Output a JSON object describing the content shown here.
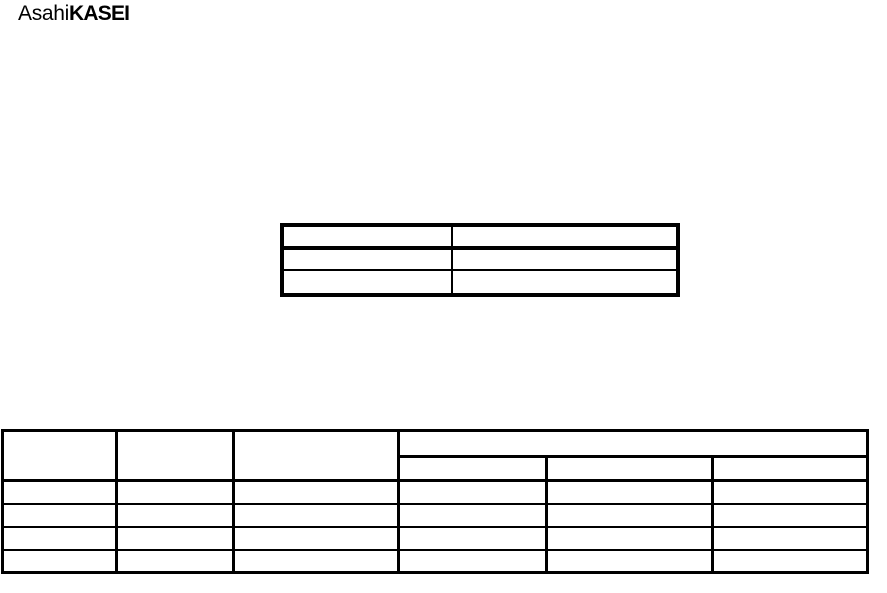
{
  "page": {
    "background": "#ffffff",
    "line_color": "#000000"
  },
  "logo": {
    "regular": "Asahi",
    "bold": "KASEI"
  },
  "info_table": {
    "rows": [
      [
        "",
        ""
      ],
      [
        "",
        ""
      ],
      [
        "",
        ""
      ]
    ]
  },
  "main_table": {
    "header": {
      "col1": "",
      "col2": "",
      "col3": "",
      "merged": "",
      "sub1": "",
      "sub2": "",
      "sub3": ""
    },
    "rows": [
      [
        "",
        "",
        "",
        "",
        "",
        ""
      ],
      [
        "",
        "",
        "",
        "",
        "",
        ""
      ],
      [
        "",
        "",
        "",
        "",
        "",
        ""
      ],
      [
        "",
        "",
        "",
        "",
        "",
        ""
      ]
    ]
  }
}
